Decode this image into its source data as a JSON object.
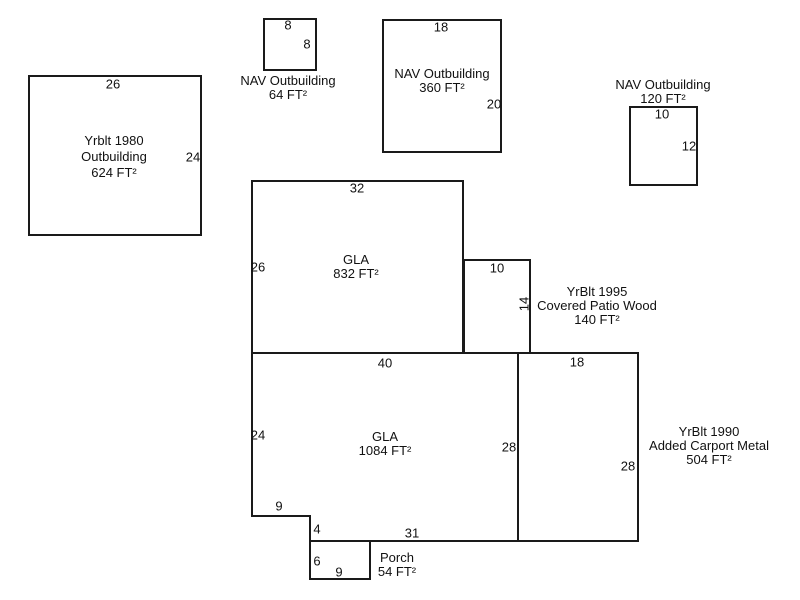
{
  "sketch": {
    "outbuilding_1980": {
      "label": [
        "Yrblt 1980",
        "Outbuilding",
        "624 FT²"
      ],
      "dim_top": "26",
      "dim_right": "24"
    },
    "nav_64": {
      "label": [
        "NAV Outbuilding",
        "64 FT²"
      ],
      "dim_top": "8",
      "dim_right": "8"
    },
    "nav_360": {
      "label": [
        "NAV Outbuilding",
        "360 FT²"
      ],
      "dim_top": "18",
      "dim_right": "20"
    },
    "nav_120": {
      "label": [
        "NAV Outbuilding",
        "120 FT²"
      ],
      "dim_top": "10",
      "dim_right": "12"
    },
    "gla_832": {
      "label": [
        "GLA",
        "832 FT²"
      ],
      "dim_top": "32",
      "dim_left": "26"
    },
    "covered_patio": {
      "label": [
        "YrBlt 1995",
        "Covered Patio Wood",
        "140 FT²"
      ],
      "dim_top": "10",
      "dim_right": "14"
    },
    "gla_1084": {
      "label": [
        "GLA",
        "1084 FT²"
      ],
      "dim_top": "40",
      "dim_left": "24",
      "dim_right": "28",
      "dim_notch_h": "9",
      "dim_notch_v": "4",
      "dim_bottom": "31"
    },
    "carport": {
      "label": [
        "YrBlt 1990",
        "Added Carport Metal",
        "504 FT²"
      ],
      "dim_top": "18",
      "dim_right": "28"
    },
    "porch": {
      "label": [
        "Porch",
        "54 FT²"
      ],
      "dim_left": "6",
      "dim_bottom": "9"
    },
    "colors": {
      "line": "#1a1a1a",
      "text": "#111111",
      "background": "#ffffff"
    }
  }
}
